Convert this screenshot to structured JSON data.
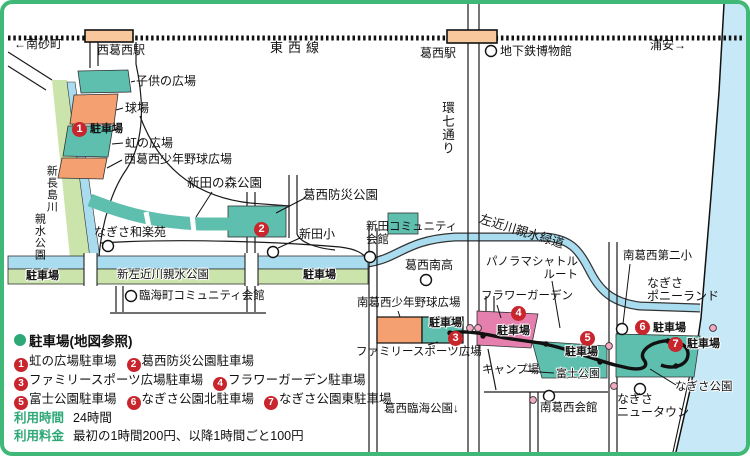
{
  "map": {
    "rail": {
      "line": "東西線",
      "west_terminus": "←南砂町",
      "east_terminus": "浦安→"
    },
    "stations": {
      "nishikasai": "西葛西駅",
      "kasai": "葛西駅"
    },
    "parking_word": "駐車場",
    "labels": {
      "metro_museum": "地下鉄博物館",
      "kodomo": "子供の広場",
      "kyujo": "球場",
      "niji": "虹の広場",
      "nishikasai_yakyu": "西葛西少年野球広場",
      "nitta_mori": "新田の森公園",
      "kasai_bosai": "葛西防災公園",
      "nagisa_waraku": "なぎさ和楽苑",
      "nitta_sho": "新田小",
      "nitta_community": "新田コミュニティ\n会館",
      "shinnagashima_a": "新長島川",
      "shinnagashima_b": "親水公園",
      "shinsakon": "新左近川親水公園",
      "rinkai_community": "臨海町コミュニティ会館",
      "kannana": "環七通り",
      "kasai_minami_high": "葛西南高",
      "sakongawa": "左近川親水緑道",
      "panorama": "パノラマシャトル\nルート",
      "minamikasai2": "南葛西第二小",
      "pony": "なぎさ\nポニーランド",
      "minamikasai_yakyu": "南葛西少年野球広場",
      "family_sports": "ファミリースポーツ広場",
      "flower": "フラワーガーデン",
      "camp": "キャンプ場",
      "fuji": "富士公園",
      "nagisa_park": "なぎさ公園",
      "newtown": "なぎさ\nニュータウン",
      "minamikasai_hall": "南葛西会館",
      "kasai_rinkai": "葛西臨海公園↓"
    },
    "markers": {
      "m1": "1",
      "m2": "2",
      "m3": "3",
      "m4": "4",
      "m5": "5",
      "m6": "6",
      "m7": "7"
    },
    "colors": {
      "frame": "#3FB878",
      "park_teal": "#5FBFAE",
      "field_orange": "#F4A070",
      "flower_pink": "#E57FAE",
      "water_blue": "#A9DCEE",
      "sea_blue": "#C7E9F7",
      "bank_green": "#CBE4AB",
      "station_peach": "#F8C79B",
      "marker_red": "#C9252D"
    }
  },
  "legend": {
    "title": "駐車場(地図参照)",
    "rows": [
      [
        {
          "n": "1",
          "label": "虹の広場駐車場"
        },
        {
          "n": "2",
          "label": "葛西防災公園駐車場"
        }
      ],
      [
        {
          "n": "3",
          "label": "ファミリースポーツ広場駐車場"
        },
        {
          "n": "4",
          "label": "フラワーガーデン駐車場"
        }
      ],
      [
        {
          "n": "5",
          "label": "富士公園駐車場"
        },
        {
          "n": "6",
          "label": "なぎさ公園北駐車場"
        },
        {
          "n": "7",
          "label": "なぎさ公園東駐車場"
        }
      ]
    ],
    "hours_label": "利用時間",
    "hours_value": "24時間",
    "fee_label": "利用料金",
    "fee_value": "最初の1時間200円、以降1時間ごと100円"
  }
}
